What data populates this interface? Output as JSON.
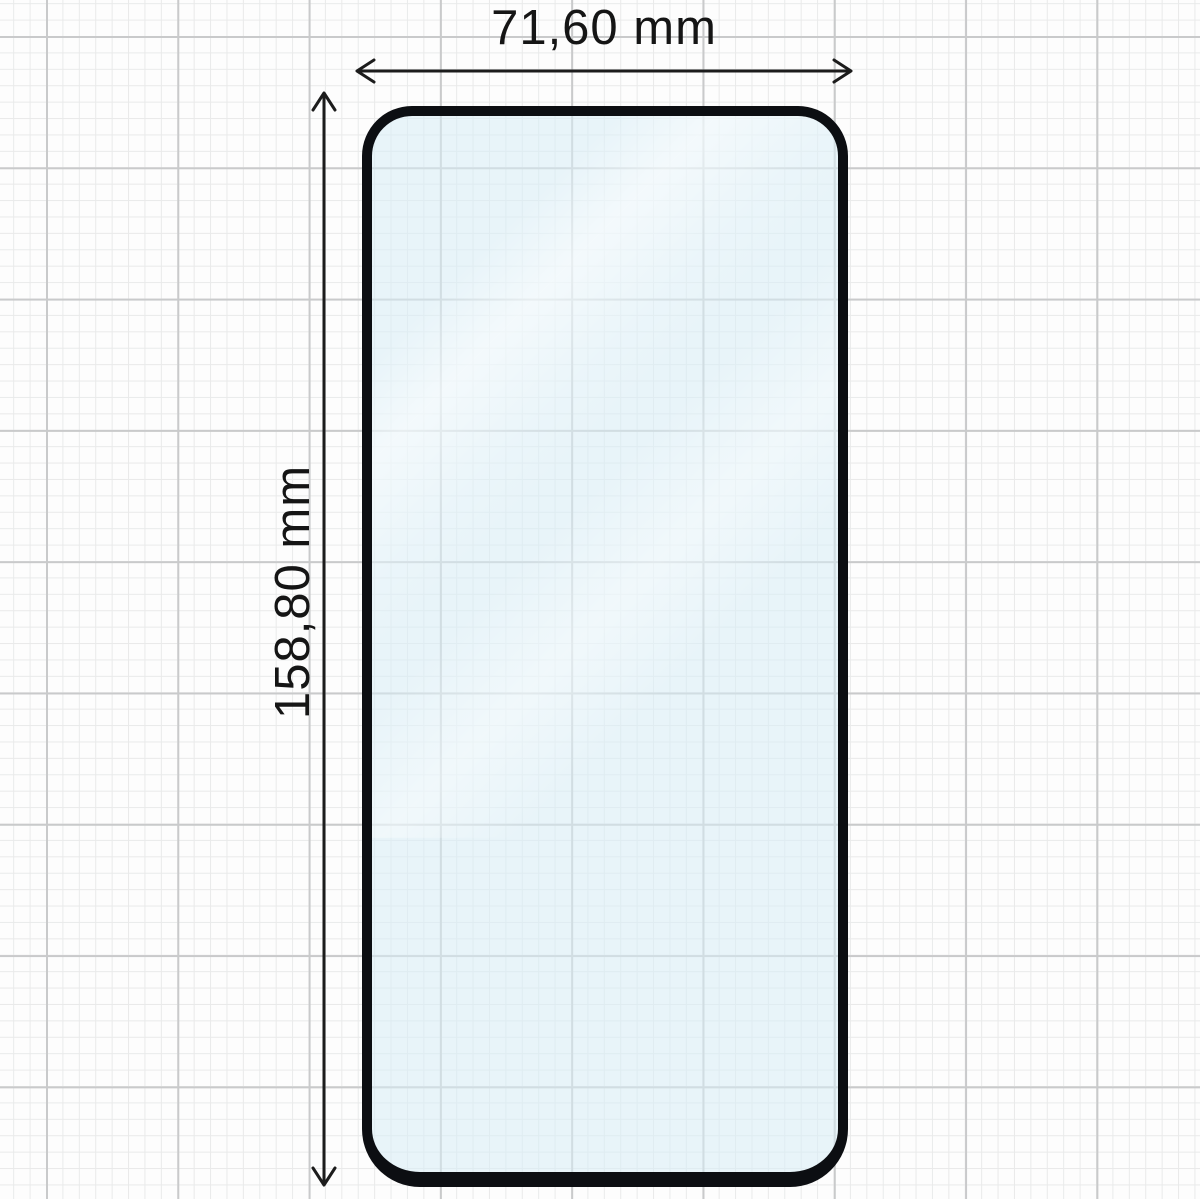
{
  "diagram": {
    "kind": "screen-protector-dimension-diagram",
    "width_dimension": {
      "label": "71,60 mm",
      "value_mm": 71.6
    },
    "height_dimension": {
      "label": "158,80 mm",
      "value_mm": 158.8
    }
  },
  "colors": {
    "background": "#fdfdfd",
    "grid_minor": "#e9eaea",
    "grid_major": "#c9cacb",
    "glass_outline": "#0c0e12",
    "glass_tint": "#d7ecf5",
    "dimension_lines": "#1c1c1c",
    "label_text": "#151515"
  }
}
